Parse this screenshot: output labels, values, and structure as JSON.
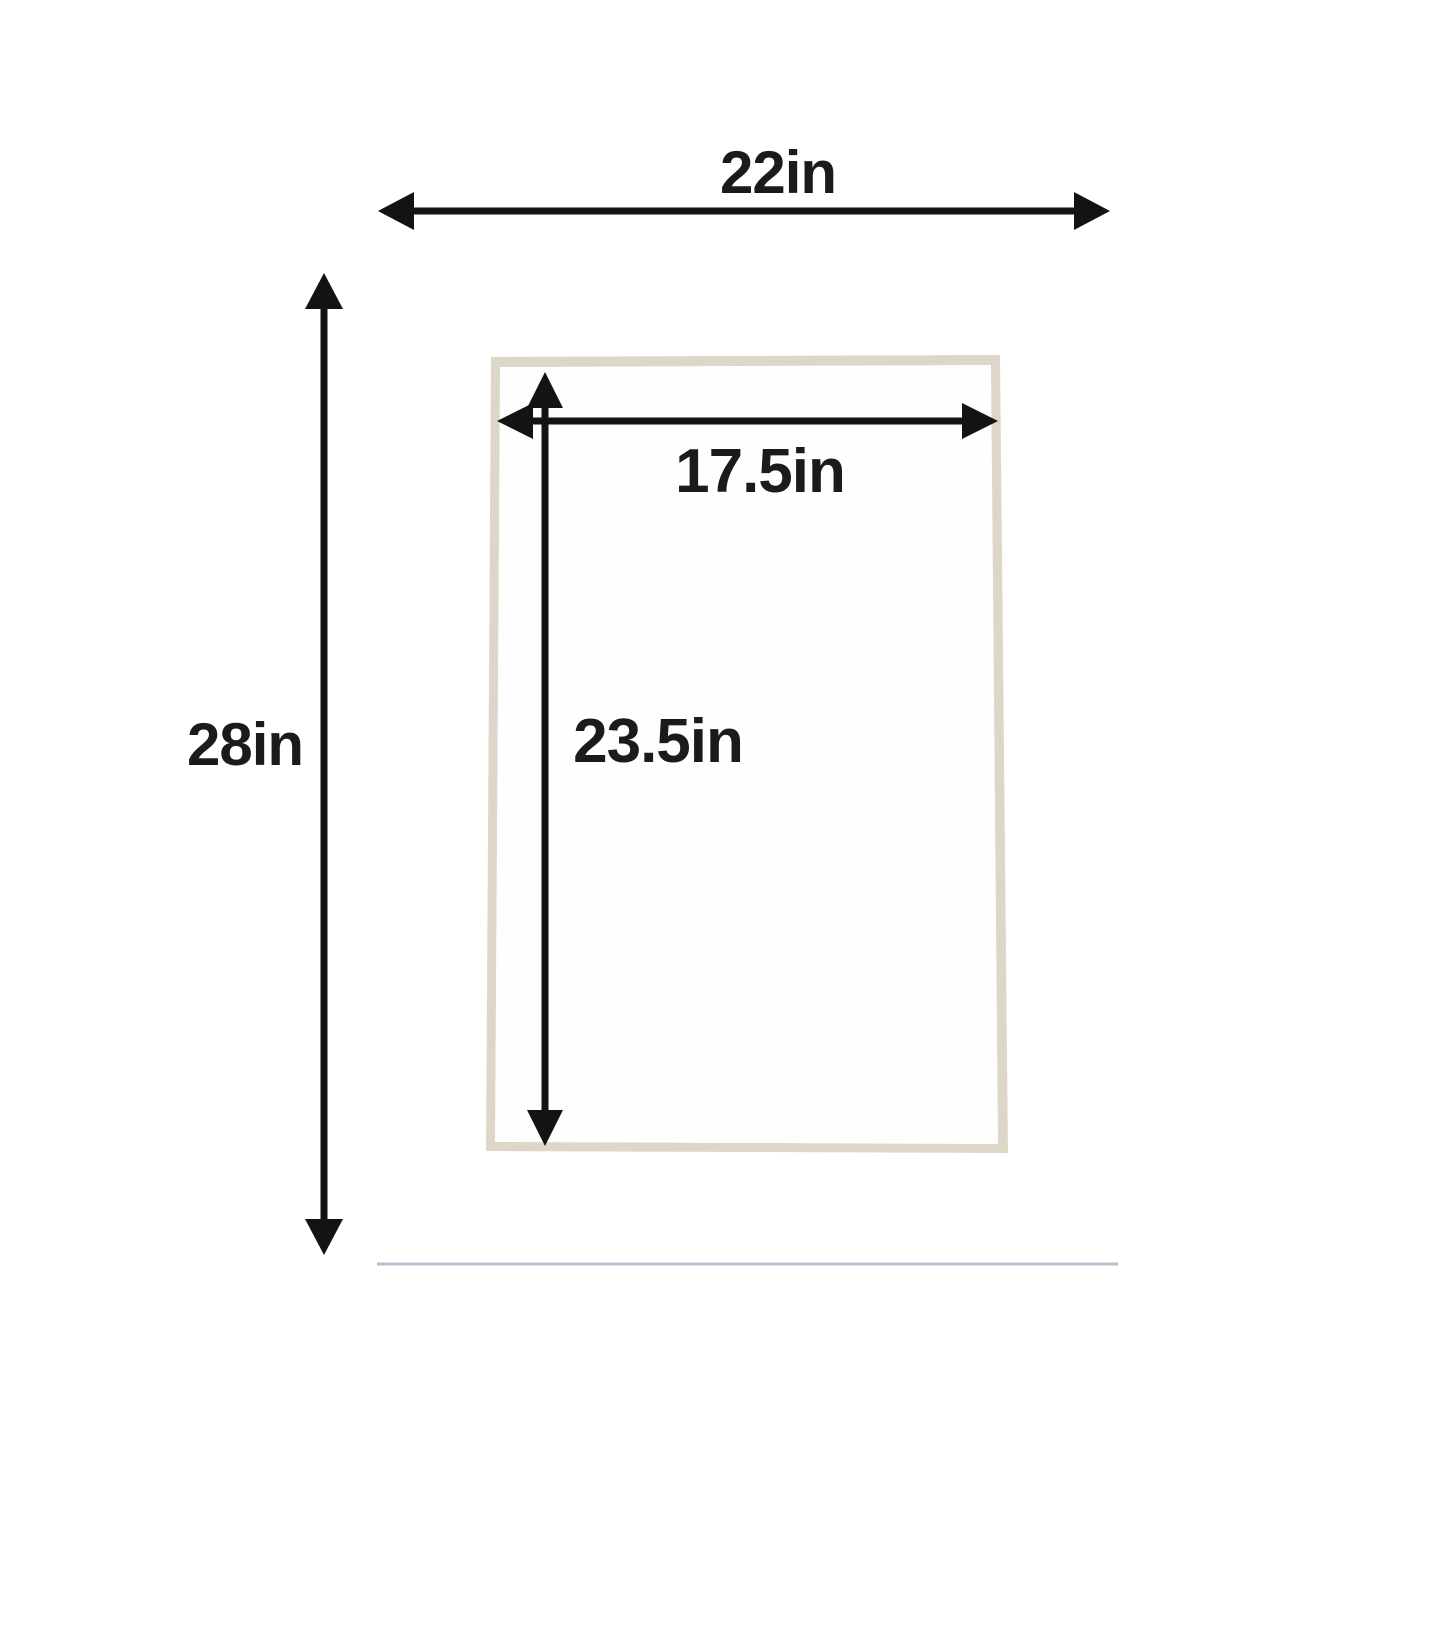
{
  "diagram": {
    "outer": {
      "width_label": "22in",
      "height_label": "28in"
    },
    "opening": {
      "width_label": "17.5in",
      "height_label": "23.5in"
    }
  },
  "colors": {
    "background": "#ffffff",
    "mat": "#1a2769",
    "mat_mottle": "#31418f",
    "mat_grain": "#0a1238",
    "mat_edge": "#b9bed2",
    "bevel": "#dcd7c8",
    "opening": "#fefefe",
    "arrow": "#131313",
    "label_text": "#1b1b1b"
  }
}
